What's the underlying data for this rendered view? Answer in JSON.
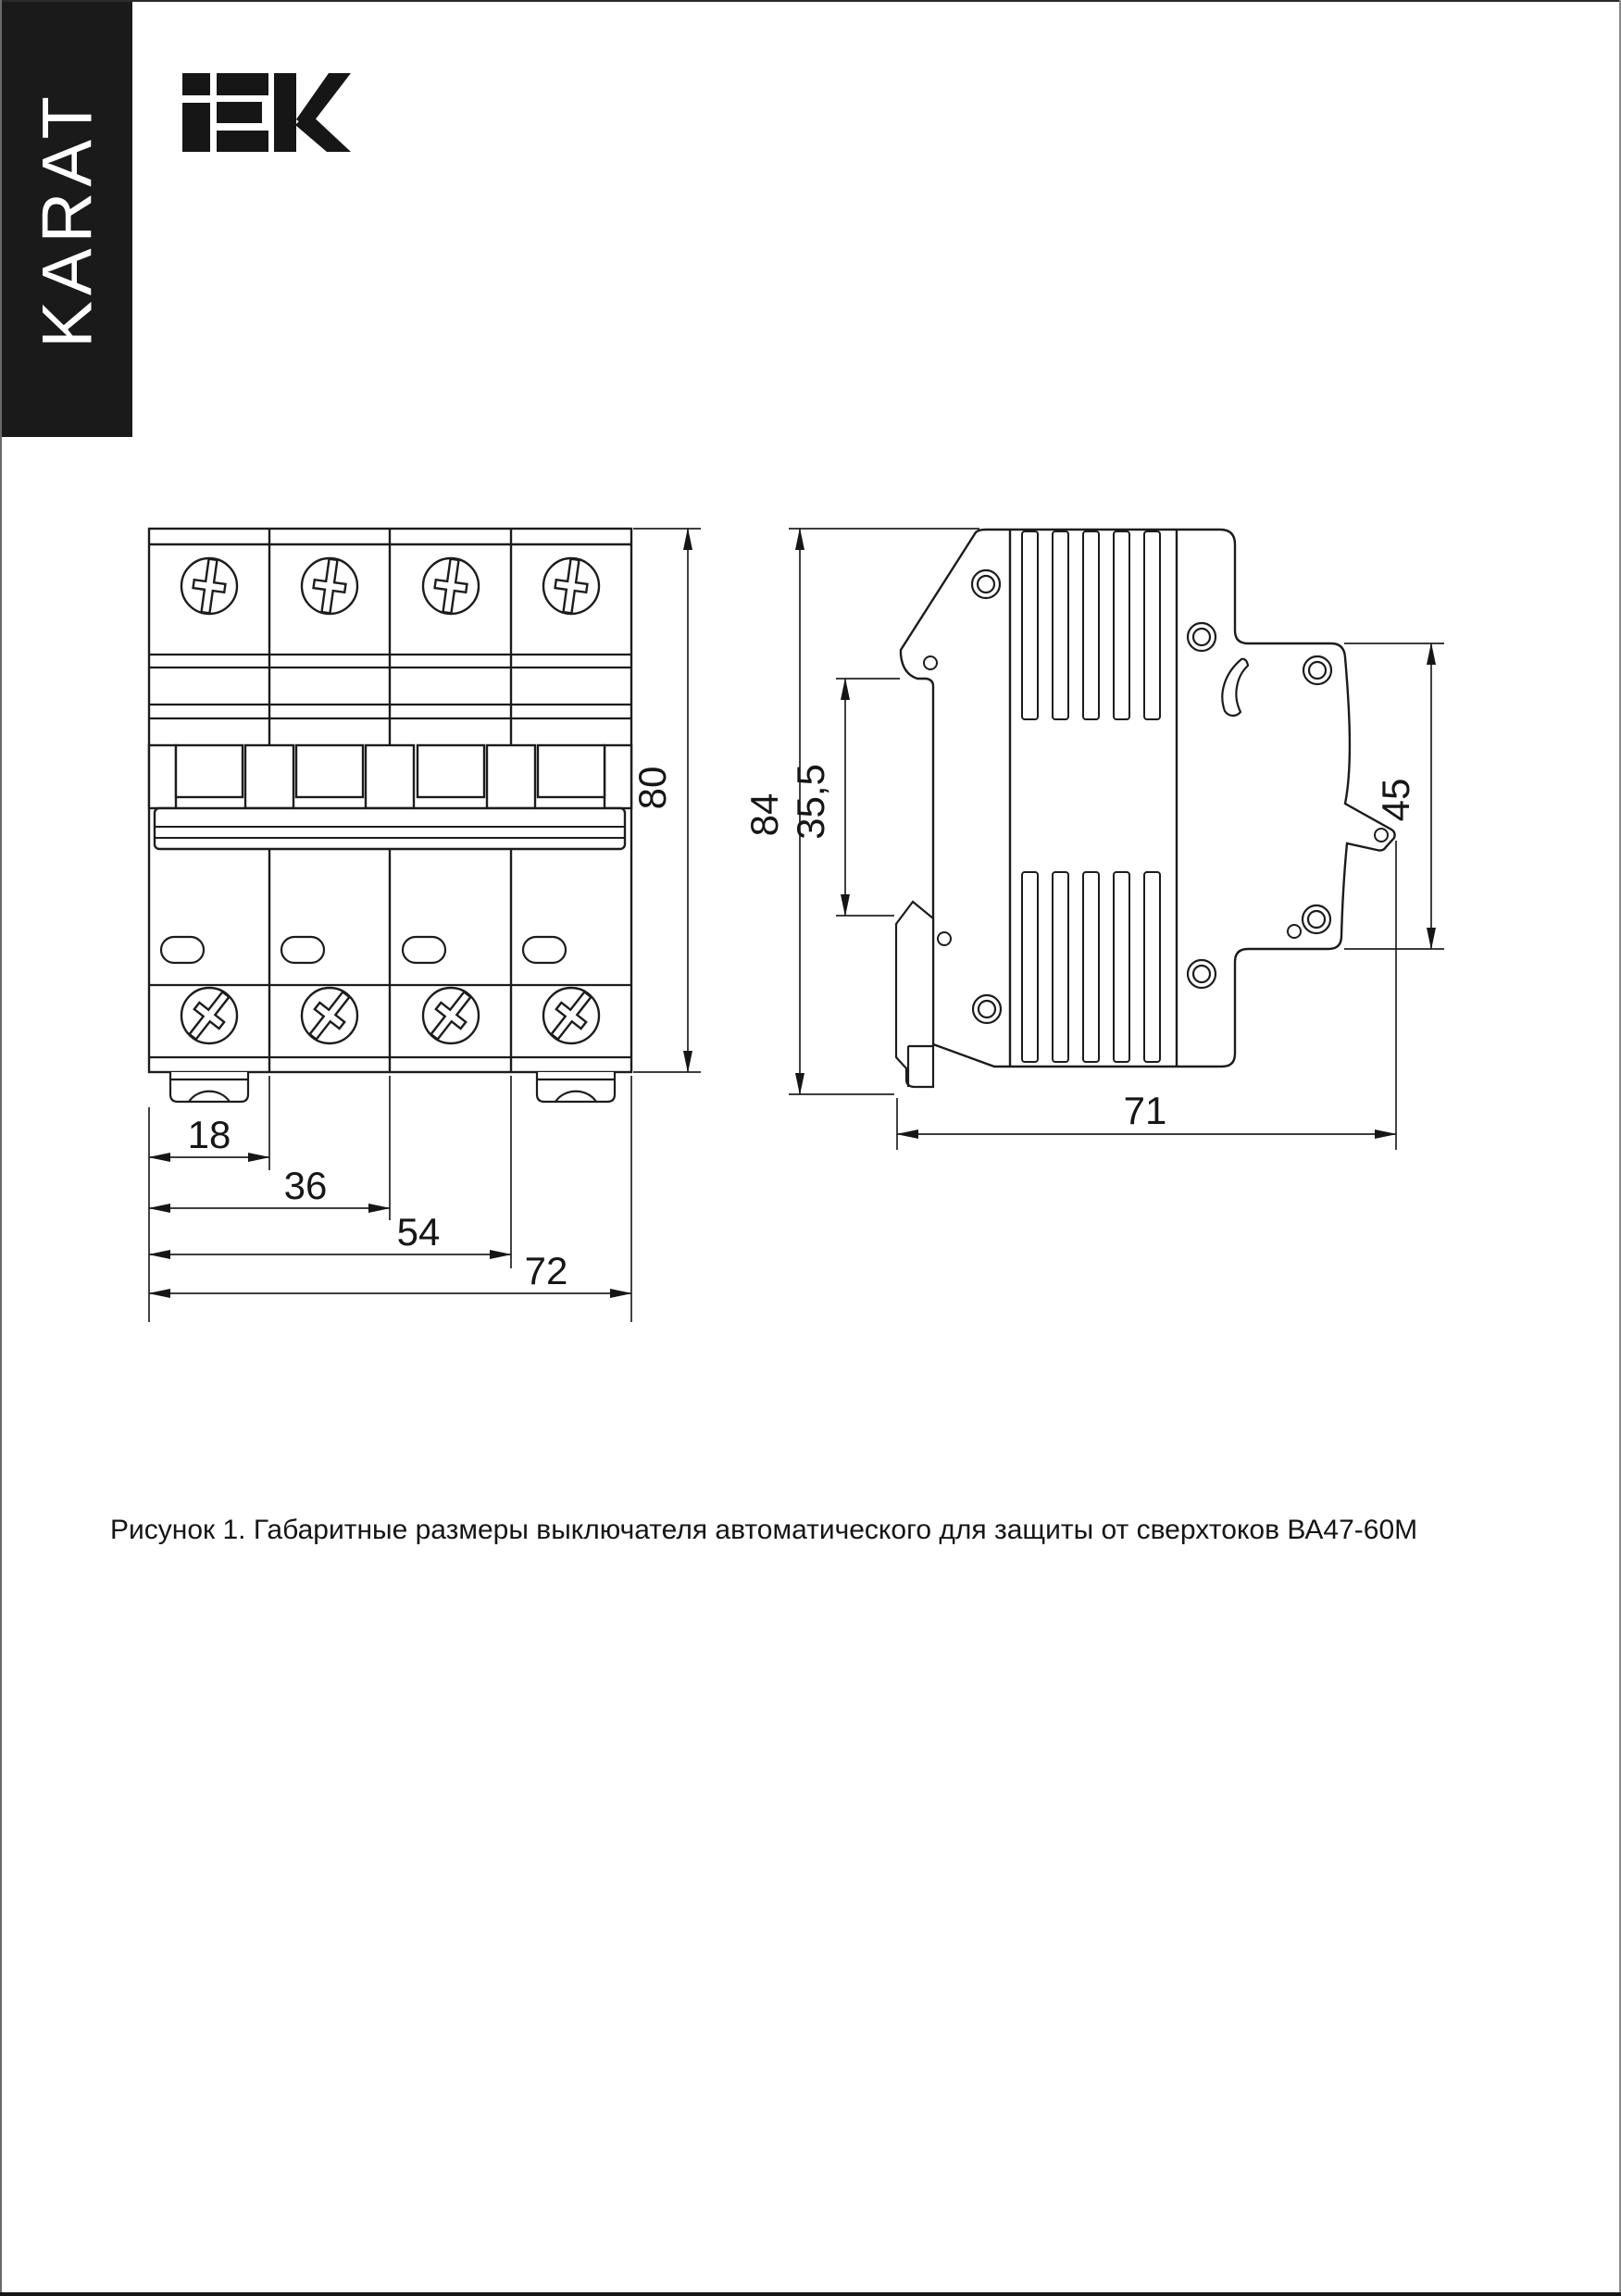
{
  "brand": {
    "series_label": "KARAT",
    "logo_text": "iEK"
  },
  "figure": {
    "caption": "Рисунок 1. Габаритные размеры выключателя автоматического для защиты от сверхтоков ВА47-60М",
    "front_view": {
      "dims": {
        "d18": "18",
        "d36": "36",
        "d54": "54",
        "d72": "72",
        "d80": "80"
      }
    },
    "side_view": {
      "dims": {
        "d84": "84",
        "d355": "35,5",
        "d45": "45",
        "d71": "71"
      }
    }
  }
}
